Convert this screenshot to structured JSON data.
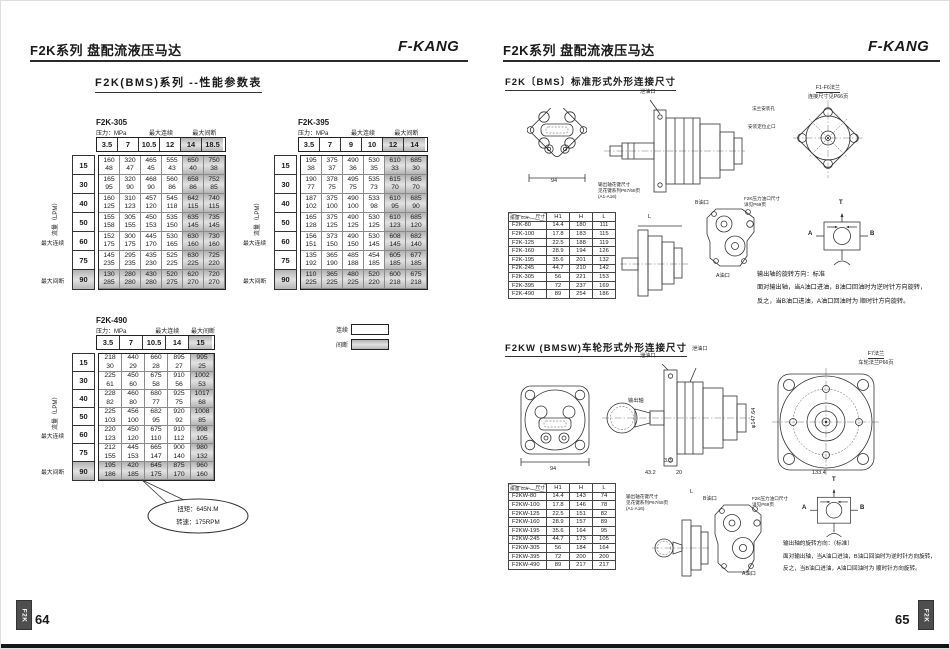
{
  "left": {
    "header_title": "F2K系列 盘配流液压马达",
    "brand": "F-KANG",
    "section_title": "F2K(BMS)系列 --性能参数表",
    "axis": {
      "pressure": "压力：MPa",
      "max_cont": "最大连续",
      "max_int": "最大间断",
      "flow": "流量（LPM）"
    },
    "legend": {
      "cont": "连续",
      "int": "间断"
    },
    "callout": {
      "line1": "扭矩：645N.M",
      "line2": "转速：175RPM"
    },
    "tables": [
      {
        "model": "F2K-305",
        "pressures": [
          "3.5",
          "7",
          "10.5",
          "12",
          "14",
          "18.5"
        ],
        "shaded_cols": 2,
        "label_spans": [
          2,
          2,
          2
        ],
        "flows": [
          "15",
          "30",
          "40",
          "50",
          "60",
          "75",
          "90"
        ],
        "rows": [
          [
            [
              "160",
              "48"
            ],
            [
              "320",
              "47"
            ],
            [
              "465",
              "45"
            ],
            [
              "555",
              "43"
            ],
            [
              "650",
              "40"
            ],
            [
              "750",
              "38"
            ]
          ],
          [
            [
              "165",
              "95"
            ],
            [
              "320",
              "90"
            ],
            [
              "468",
              "90"
            ],
            [
              "560",
              "86"
            ],
            [
              "658",
              "86"
            ],
            [
              "752",
              "85"
            ]
          ],
          [
            [
              "160",
              "125"
            ],
            [
              "310",
              "123"
            ],
            [
              "457",
              "120"
            ],
            [
              "545",
              "118"
            ],
            [
              "642",
              "115"
            ],
            [
              "740",
              "115"
            ]
          ],
          [
            [
              "155",
              "158"
            ],
            [
              "305",
              "155"
            ],
            [
              "450",
              "153"
            ],
            [
              "535",
              "150"
            ],
            [
              "635",
              "145"
            ],
            [
              "735",
              "145"
            ]
          ],
          [
            [
              "152",
              "175"
            ],
            [
              "300",
              "175"
            ],
            [
              "445",
              "170"
            ],
            [
              "530",
              "165"
            ],
            [
              "630",
              "160"
            ],
            [
              "730",
              "160"
            ]
          ],
          [
            [
              "145",
              "235"
            ],
            [
              "295",
              "235"
            ],
            [
              "435",
              "230"
            ],
            [
              "525",
              "225"
            ],
            [
              "630",
              "225"
            ],
            [
              "725",
              "220"
            ]
          ],
          [
            [
              "130",
              "285"
            ],
            [
              "280",
              "280"
            ],
            [
              "430",
              "280"
            ],
            [
              "520",
              "275"
            ],
            [
              "620",
              "270"
            ],
            [
              "720",
              "270"
            ]
          ]
        ]
      },
      {
        "model": "F2K-395",
        "pressures": [
          "3.5",
          "7",
          "9",
          "10",
          "12",
          "14"
        ],
        "shaded_cols": 2,
        "label_spans": [
          2,
          2,
          2
        ],
        "flows": [
          "15",
          "30",
          "40",
          "50",
          "60",
          "75",
          "90"
        ],
        "rows": [
          [
            [
              "195",
              "38"
            ],
            [
              "375",
              "37"
            ],
            [
              "490",
              "36"
            ],
            [
              "530",
              "35"
            ],
            [
              "610",
              "33"
            ],
            [
              "685",
              "30"
            ]
          ],
          [
            [
              "190",
              "77"
            ],
            [
              "378",
              "75"
            ],
            [
              "495",
              "75"
            ],
            [
              "535",
              "73"
            ],
            [
              "615",
              "70"
            ],
            [
              "685",
              "70"
            ]
          ],
          [
            [
              "187",
              "102"
            ],
            [
              "375",
              "100"
            ],
            [
              "490",
              "100"
            ],
            [
              "533",
              "98"
            ],
            [
              "610",
              "95"
            ],
            [
              "685",
              "90"
            ]
          ],
          [
            [
              "165",
              "128"
            ],
            [
              "375",
              "125"
            ],
            [
              "490",
              "125"
            ],
            [
              "530",
              "125"
            ],
            [
              "610",
              "123"
            ],
            [
              "685",
              "120"
            ]
          ],
          [
            [
              "156",
              "151"
            ],
            [
              "373",
              "150"
            ],
            [
              "490",
              "150"
            ],
            [
              "530",
              "145"
            ],
            [
              "608",
              "145"
            ],
            [
              "682",
              "140"
            ]
          ],
          [
            [
              "135",
              "192"
            ],
            [
              "365",
              "190"
            ],
            [
              "485",
              "188"
            ],
            [
              "454",
              "185"
            ],
            [
              "605",
              "185"
            ],
            [
              "677",
              "185"
            ]
          ],
          [
            [
              "110",
              "225"
            ],
            [
              "365",
              "225"
            ],
            [
              "480",
              "225"
            ],
            [
              "520",
              "220"
            ],
            [
              "600",
              "218"
            ],
            [
              "675",
              "218"
            ]
          ]
        ]
      },
      {
        "model": "F2K-490",
        "pressures": [
          "3.5",
          "7",
          "10.5",
          "14",
          "15"
        ],
        "shaded_cols": 1,
        "label_spans": [
          2,
          2,
          1
        ],
        "flows": [
          "15",
          "30",
          "40",
          "50",
          "60",
          "75",
          "90"
        ],
        "rows": [
          [
            [
              "218",
              "30"
            ],
            [
              "440",
              "29"
            ],
            [
              "660",
              "28"
            ],
            [
              "895",
              "27"
            ],
            [
              "995",
              "25"
            ]
          ],
          [
            [
              "225",
              "61"
            ],
            [
              "450",
              "60"
            ],
            [
              "675",
              "58"
            ],
            [
              "910",
              "56"
            ],
            [
              "1002",
              "53"
            ]
          ],
          [
            [
              "228",
              "82"
            ],
            [
              "460",
              "80"
            ],
            [
              "680",
              "77"
            ],
            [
              "925",
              "75"
            ],
            [
              "1017",
              "68"
            ]
          ],
          [
            [
              "225",
              "103"
            ],
            [
              "456",
              "100"
            ],
            [
              "682",
              "95"
            ],
            [
              "920",
              "92"
            ],
            [
              "1008",
              "85"
            ]
          ],
          [
            [
              "220",
              "123"
            ],
            [
              "450",
              "120"
            ],
            [
              "675",
              "110"
            ],
            [
              "910",
              "112"
            ],
            [
              "998",
              "105"
            ]
          ],
          [
            [
              "212",
              "155"
            ],
            [
              "445",
              "153"
            ],
            [
              "665",
              "147"
            ],
            [
              "900",
              "140"
            ],
            [
              "980",
              "132"
            ]
          ],
          [
            [
              "195",
              "186"
            ],
            [
              "420",
              "185"
            ],
            [
              "645",
              "175"
            ],
            [
              "875",
              "170"
            ],
            [
              "960",
              "160"
            ]
          ]
        ]
      }
    ],
    "page_number": "64",
    "tab": "F2K"
  },
  "right": {
    "header_title": "F2K系列 盘配流液压马达",
    "brand": "F-KANG",
    "section1_title": "F2K〔BMS〕标准形式外形连接尺寸",
    "section2_title": "F2KW (BMSW)车轮形式外形连接尺寸",
    "dim_table1": {
      "diag_top": "尺寸",
      "diag_bottom": "排量 cc/r",
      "cols": [
        "H1",
        "H",
        "L"
      ],
      "rows": [
        [
          "F2K-80",
          "14.4",
          "180",
          "111"
        ],
        [
          "F2K-100",
          "17.8",
          "183",
          "115"
        ],
        [
          "F2K-125",
          "22.5",
          "188",
          "119"
        ],
        [
          "F2K-160",
          "28.9",
          "194",
          "126"
        ],
        [
          "F2K-195",
          "35.6",
          "201",
          "132"
        ],
        [
          "F2K-245",
          "44.7",
          "210",
          "142"
        ],
        [
          "F2K-305",
          "56",
          "221",
          "153"
        ],
        [
          "F2K-395",
          "72",
          "237",
          "169"
        ],
        [
          "F2K-490",
          "89",
          "254",
          "186"
        ]
      ]
    },
    "dim_table2": {
      "diag_top": "尺寸",
      "diag_bottom": "排量 cc/r",
      "cols": [
        "H1",
        "H",
        "L"
      ],
      "rows": [
        [
          "F2KW-80",
          "14.4",
          "143",
          "74"
        ],
        [
          "F2KW-100",
          "17.8",
          "146",
          "78"
        ],
        [
          "F2KW-125",
          "22.5",
          "151",
          "82"
        ],
        [
          "F2KW-160",
          "28.9",
          "157",
          "89"
        ],
        [
          "F2KW-195",
          "35.6",
          "164",
          "95"
        ],
        [
          "F2KW-245",
          "44.7",
          "173",
          "105"
        ],
        [
          "F2KW-305",
          "56",
          "184",
          "164"
        ],
        [
          "F2KW-395",
          "72",
          "200",
          "200"
        ],
        [
          "F2KW-490",
          "89",
          "217",
          "217"
        ]
      ]
    },
    "labels": {
      "flange_std": "F1-F6法兰",
      "flange_std_sub": "连接尺寸见P66页",
      "flange_hole": "法兰安装孔",
      "flange_pilot": "安装定位止口",
      "drain": "泄油口",
      "shaft_note1": "输出轴花键尺寸",
      "shaft_note2": "见花键系列P67/68页",
      "shaft_note3": "(A1-A16)",
      "port_b": "B油口",
      "port_a": "A油口",
      "port_size1": "F2K压力油口尺寸",
      "port_size2": "详见P69页",
      "flange_wheel": "F7法兰",
      "flange_wheel_sub": "车轮法兰P66页",
      "output_shaft": "输出轴",
      "sch_a": "A",
      "sch_b": "B",
      "sch_t": "T",
      "dim_94": "94",
      "dim_L": "L",
      "dim_43_2": "43.2",
      "dim_20": "20",
      "dim_3_3": "3.3",
      "dim_133_4": "133.4",
      "dim_d147": "φ147.64"
    },
    "notes1": {
      "l1": "输出轴的旋转方向：标准",
      "l2": "面对输出轴，当A油口进油，B油口回油时为逆时针方向旋转，",
      "l3": "反之，当B油口进油，A油口回油时为 顺时针方向旋转。"
    },
    "notes2": {
      "l1": "输出轴的旋转方向：（标准）",
      "l2": "面对输出轴，当A油口进油，B油口回油时为逆时针方向旋转，",
      "l3": "反之，当B油口进油，A油口回油时为 顺时针方向旋转。"
    },
    "page_number": "65",
    "tab": "F2K"
  }
}
